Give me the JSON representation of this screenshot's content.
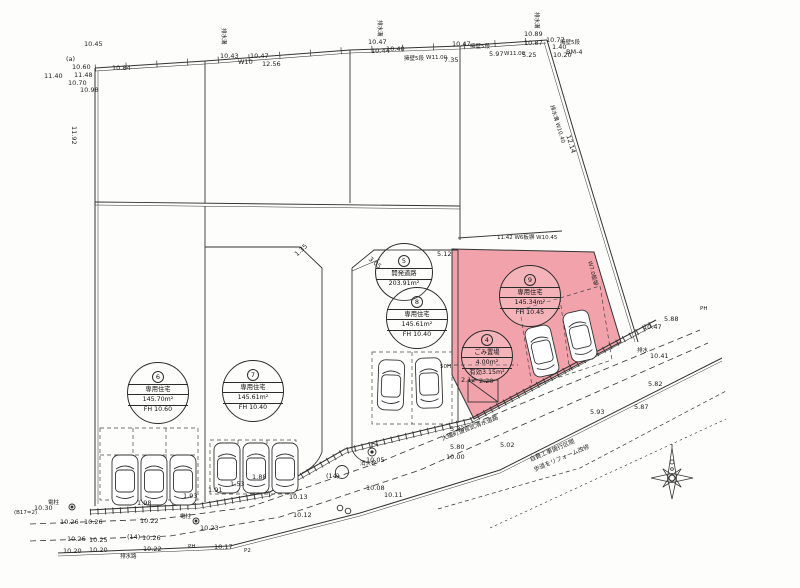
{
  "colors": {
    "highlight_parcel": "#f2a2aa",
    "line": "#333333",
    "paper": "#fdfdfb"
  },
  "badges": [
    {
      "id": "lot6",
      "x": 158,
      "y": 393,
      "d": 62,
      "num": "6",
      "rows": [
        "専用住宅",
        "145.70m²",
        "FH 10.60"
      ]
    },
    {
      "id": "lot7",
      "x": 253,
      "y": 391,
      "d": 62,
      "num": "7",
      "rows": [
        "専用住宅",
        "145.61m²",
        "FH 10.40"
      ]
    },
    {
      "id": "devroad",
      "x": 404,
      "y": 272,
      "d": 58,
      "num": "5",
      "rows": [
        "開発道路",
        "203.91m²"
      ]
    },
    {
      "id": "lot8",
      "x": 417,
      "y": 318,
      "d": 62,
      "num": "8",
      "rows": [
        "専用住宅",
        "145.61m²",
        "FH 10.40"
      ]
    },
    {
      "id": "lot9",
      "x": 530,
      "y": 296,
      "d": 62,
      "num": "9",
      "rows": [
        "専用住宅",
        "145.34m²",
        "FH 10.45"
      ]
    },
    {
      "id": "garbage",
      "x": 487,
      "y": 356,
      "d": 52,
      "num": "4",
      "rows": [
        "ごみ置場",
        "4.00m²",
        "有効3.15m²"
      ]
    }
  ],
  "cars": [
    {
      "x": 112,
      "y": 455,
      "r": 0
    },
    {
      "x": 141,
      "y": 455,
      "r": 0
    },
    {
      "x": 170,
      "y": 455,
      "r": 0
    },
    {
      "x": 214,
      "y": 443,
      "r": 0
    },
    {
      "x": 243,
      "y": 443,
      "r": 0
    },
    {
      "x": 272,
      "y": 443,
      "r": 0
    },
    {
      "x": 378,
      "y": 360,
      "r": 2
    },
    {
      "x": 416,
      "y": 358,
      "r": -2
    },
    {
      "x": 529,
      "y": 326,
      "r": -13
    },
    {
      "x": 567,
      "y": 311,
      "r": -13
    }
  ],
  "annotations": [
    {
      "x": 84,
      "y": 40,
      "t": "10.45"
    },
    {
      "x": 66,
      "y": 55,
      "t": "(a)"
    },
    {
      "x": 72,
      "y": 63,
      "t": "10.60"
    },
    {
      "x": 112,
      "y": 64,
      "t": "10.84"
    },
    {
      "x": 44,
      "y": 72,
      "t": "11.40"
    },
    {
      "x": 74,
      "y": 71,
      "t": "11.48"
    },
    {
      "x": 68,
      "y": 79,
      "t": "10.70"
    },
    {
      "x": 80,
      "y": 86,
      "t": "10.98"
    },
    {
      "x": 78,
      "y": 126,
      "t": "11.92",
      "r": 90
    },
    {
      "x": 220,
      "y": 52,
      "t": "10.43"
    },
    {
      "x": 238,
      "y": 58,
      "t": "W10"
    },
    {
      "x": 250,
      "y": 52,
      "t": "10.47"
    },
    {
      "x": 262,
      "y": 60,
      "t": "12.56"
    },
    {
      "x": 228,
      "y": 28,
      "t": "排水溝",
      "r": 90,
      "s": 5.5
    },
    {
      "x": 368,
      "y": 38,
      "t": "10.47"
    },
    {
      "x": 371,
      "y": 47,
      "t": "10.44"
    },
    {
      "x": 386,
      "y": 45,
      "t": "10.40"
    },
    {
      "x": 384,
      "y": 20,
      "t": "排水溝",
      "r": 90,
      "s": 5.5
    },
    {
      "x": 404,
      "y": 54,
      "t": "擁壁5段",
      "s": 5.5
    },
    {
      "x": 426,
      "y": 55,
      "t": "W11.00",
      "s": 5.5
    },
    {
      "x": 444,
      "y": 56,
      "t": "7.35"
    },
    {
      "x": 452,
      "y": 40,
      "t": "10.47"
    },
    {
      "x": 470,
      "y": 42,
      "t": "擁壁5段",
      "s": 5.5
    },
    {
      "x": 489,
      "y": 50,
      "t": "5.97"
    },
    {
      "x": 504,
      "y": 51,
      "t": "W11.00",
      "s": 5.5
    },
    {
      "x": 522,
      "y": 51,
      "t": "5.25"
    },
    {
      "x": 524,
      "y": 30,
      "t": "10.89"
    },
    {
      "x": 524,
      "y": 39,
      "t": "10.87"
    },
    {
      "x": 541,
      "y": 12,
      "t": "排水溝",
      "r": 90,
      "s": 5.5
    },
    {
      "x": 546,
      "y": 36,
      "t": "10.77"
    },
    {
      "x": 552,
      "y": 43,
      "t": "1.40"
    },
    {
      "x": 553,
      "y": 51,
      "t": "10.20"
    },
    {
      "x": 566,
      "y": 48,
      "t": "BM-4"
    },
    {
      "x": 560,
      "y": 38,
      "t": "擁壁5段",
      "s": 5.5
    },
    {
      "x": 556,
      "y": 104,
      "t": "排水溝 W10.40",
      "r": 73,
      "s": 5.5
    },
    {
      "x": 572,
      "y": 134,
      "t": "12.14",
      "r": 73
    },
    {
      "x": 497,
      "y": 233,
      "t": "11.42  W6板塀  W10.45",
      "s": 5.5
    },
    {
      "x": 594,
      "y": 260,
      "t": "W7.0板塀",
      "r": 76,
      "s": 5.5
    },
    {
      "x": 293,
      "y": 252,
      "t": "1.35",
      "r": -42
    },
    {
      "x": 372,
      "y": 255,
      "t": "3.05",
      "r": 40
    },
    {
      "x": 437,
      "y": 250,
      "t": "5.12"
    },
    {
      "x": 440,
      "y": 364,
      "t": "50H",
      "s": 5.5
    },
    {
      "x": 461,
      "y": 376,
      "t": "2.12"
    },
    {
      "x": 479,
      "y": 377,
      "t": "2.20"
    },
    {
      "x": 643,
      "y": 323,
      "t": "10.47"
    },
    {
      "x": 637,
      "y": 346,
      "t": "排水",
      "s": 5.5
    },
    {
      "x": 650,
      "y": 352,
      "t": "10.41"
    },
    {
      "x": 664,
      "y": 315,
      "t": "5.88"
    },
    {
      "x": 648,
      "y": 380,
      "t": "5.82"
    },
    {
      "x": 634,
      "y": 403,
      "t": "5.87"
    },
    {
      "x": 590,
      "y": 408,
      "t": "5.93"
    },
    {
      "x": 450,
      "y": 425,
      "t": "5.83"
    },
    {
      "x": 500,
      "y": 441,
      "t": "5.02"
    },
    {
      "x": 450,
      "y": 443,
      "t": "5.80"
    },
    {
      "x": 446,
      "y": 453,
      "t": "10.00"
    },
    {
      "x": 360,
      "y": 459,
      "t": "消火栓",
      "s": 5.5
    },
    {
      "x": 366,
      "y": 456,
      "t": "10.05"
    },
    {
      "x": 366,
      "y": 484,
      "t": "10.08"
    },
    {
      "x": 384,
      "y": 491,
      "t": "10.11"
    },
    {
      "x": 326,
      "y": 472,
      "t": "(14)"
    },
    {
      "x": 289,
      "y": 493,
      "t": "10.13"
    },
    {
      "x": 293,
      "y": 511,
      "t": "10.12"
    },
    {
      "x": 252,
      "y": 473,
      "t": "1.88"
    },
    {
      "x": 230,
      "y": 480,
      "t": "1.53"
    },
    {
      "x": 208,
      "y": 486,
      "t": "1.91"
    },
    {
      "x": 183,
      "y": 492,
      "t": "1.93"
    },
    {
      "x": 137,
      "y": 499,
      "t": "1.98"
    },
    {
      "x": 34,
      "y": 504,
      "t": "10.30"
    },
    {
      "x": 48,
      "y": 498,
      "t": "電柱",
      "s": 5.5
    },
    {
      "x": 14,
      "y": 510,
      "t": "(B17=2)",
      "s": 5.5
    },
    {
      "x": 60,
      "y": 518,
      "t": "10.26"
    },
    {
      "x": 84,
      "y": 518,
      "t": "10.26"
    },
    {
      "x": 140,
      "y": 517,
      "t": "10.22"
    },
    {
      "x": 67,
      "y": 535,
      "t": "10.26"
    },
    {
      "x": 89,
      "y": 536,
      "t": "10.25"
    },
    {
      "x": 127,
      "y": 533,
      "t": "(14)"
    },
    {
      "x": 142,
      "y": 534,
      "t": "10.26"
    },
    {
      "x": 63,
      "y": 547,
      "t": "10.20"
    },
    {
      "x": 89,
      "y": 546,
      "t": "10.20"
    },
    {
      "x": 143,
      "y": 545,
      "t": "10.22"
    },
    {
      "x": 188,
      "y": 544,
      "t": "PH",
      "s": 5.5
    },
    {
      "x": 214,
      "y": 543,
      "t": "10.17"
    },
    {
      "x": 180,
      "y": 512,
      "t": "電柱",
      "s": 5.5
    },
    {
      "x": 200,
      "y": 524,
      "t": "10.23"
    },
    {
      "x": 120,
      "y": 552,
      "t": "排水路",
      "s": 5.5
    },
    {
      "x": 244,
      "y": 548,
      "t": "P2",
      "s": 5.5
    },
    {
      "x": 700,
      "y": 306,
      "t": "PH",
      "s": 5.5
    },
    {
      "x": 440,
      "y": 434,
      "t": "大磯町道官武清水道路",
      "r": -21,
      "s": 6
    },
    {
      "x": 528,
      "y": 455,
      "t": "自費工事施行区間",
      "r": -23,
      "s": 6
    },
    {
      "x": 532,
      "y": 465,
      "t": "歩道をリフォーム改修",
      "r": -23,
      "s": 6
    }
  ]
}
